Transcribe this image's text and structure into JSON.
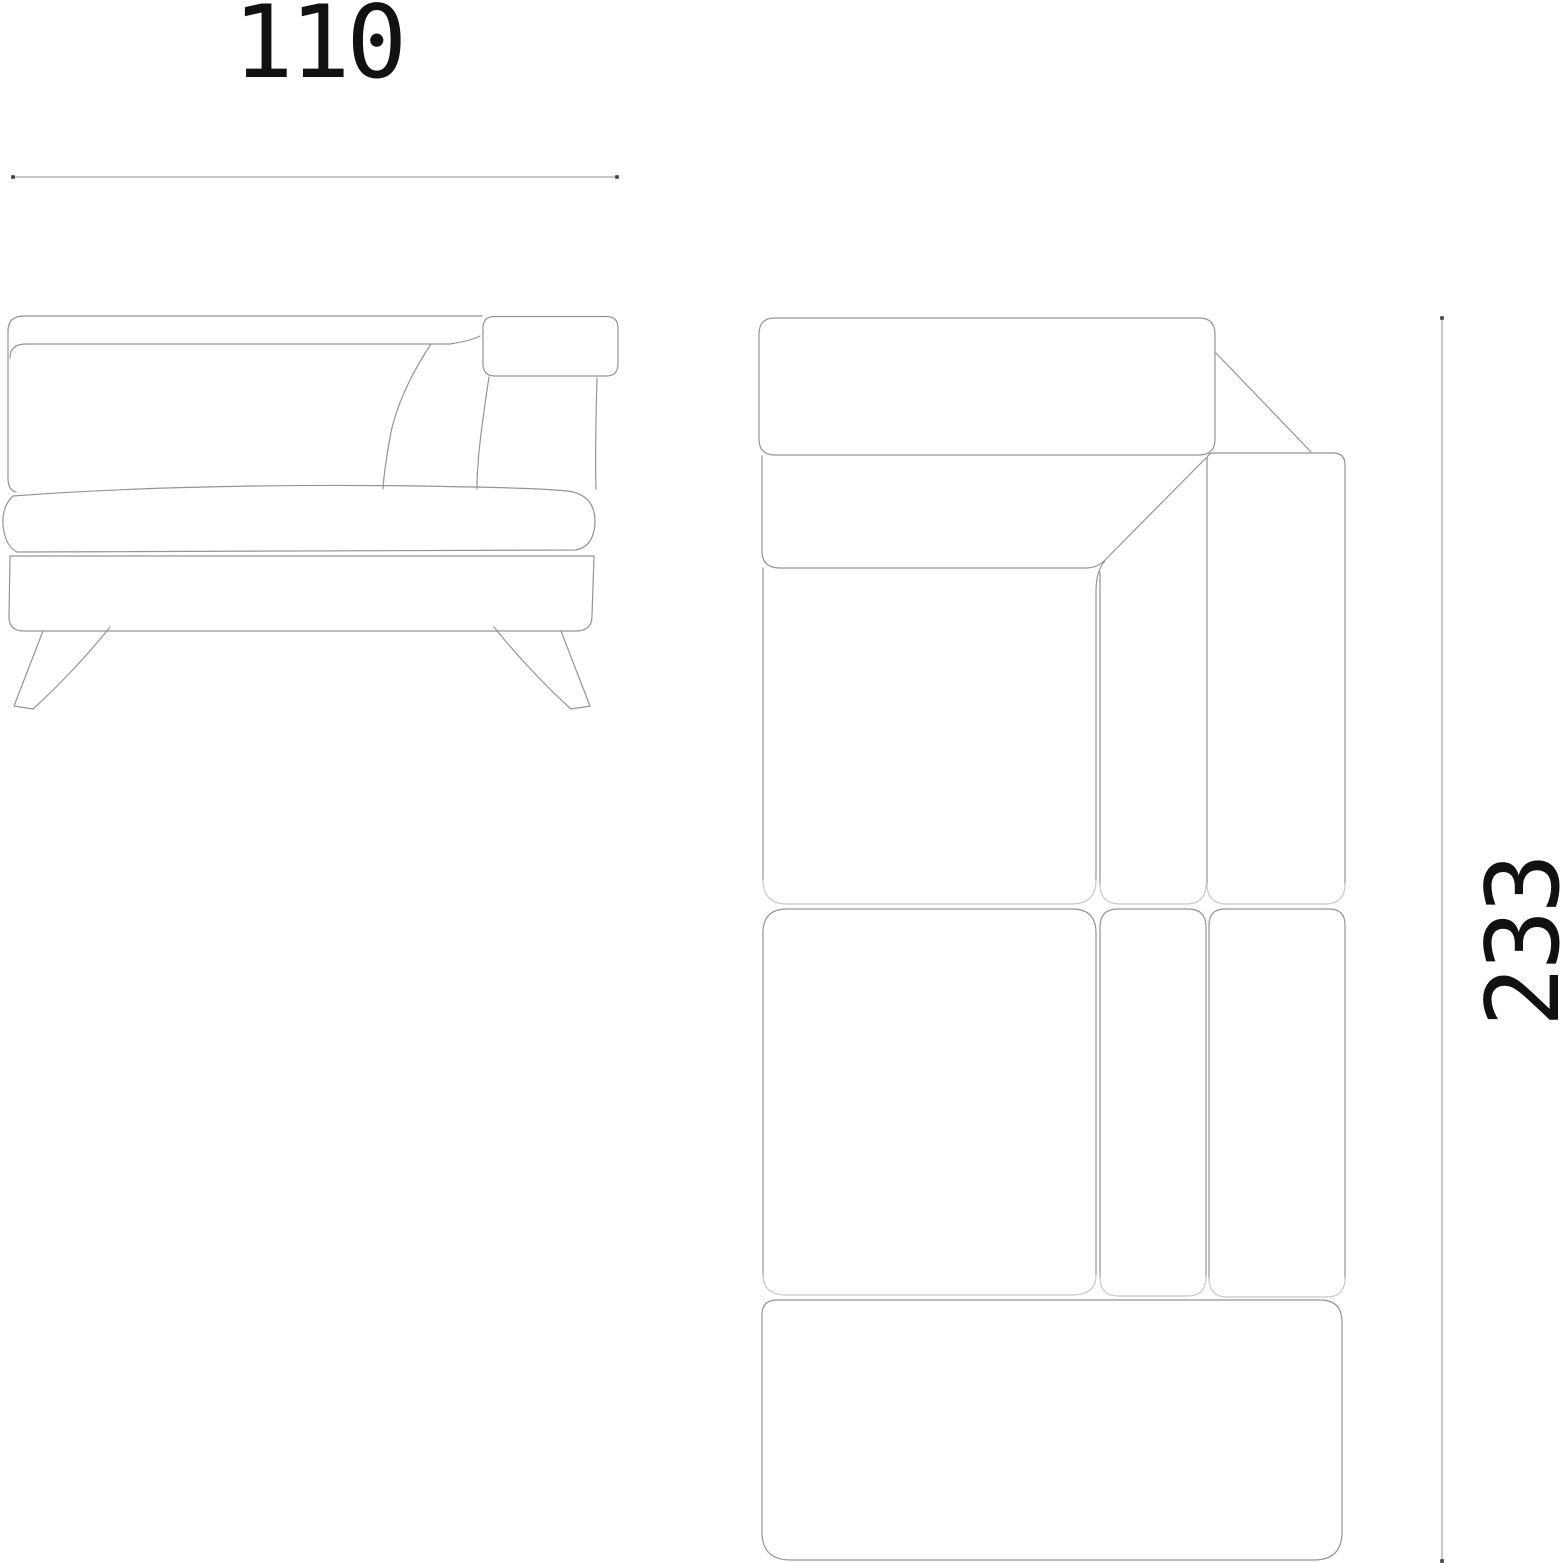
{
  "dimensions": {
    "width": {
      "value": "110"
    },
    "depth": {
      "value": "233"
    }
  },
  "colors": {
    "line": "#949494",
    "seam_light": "#c8c8c8",
    "dimension_line": "#8f8f8f",
    "tick": "#3f3f3f",
    "text": "#111111",
    "background": "#ffffff"
  }
}
